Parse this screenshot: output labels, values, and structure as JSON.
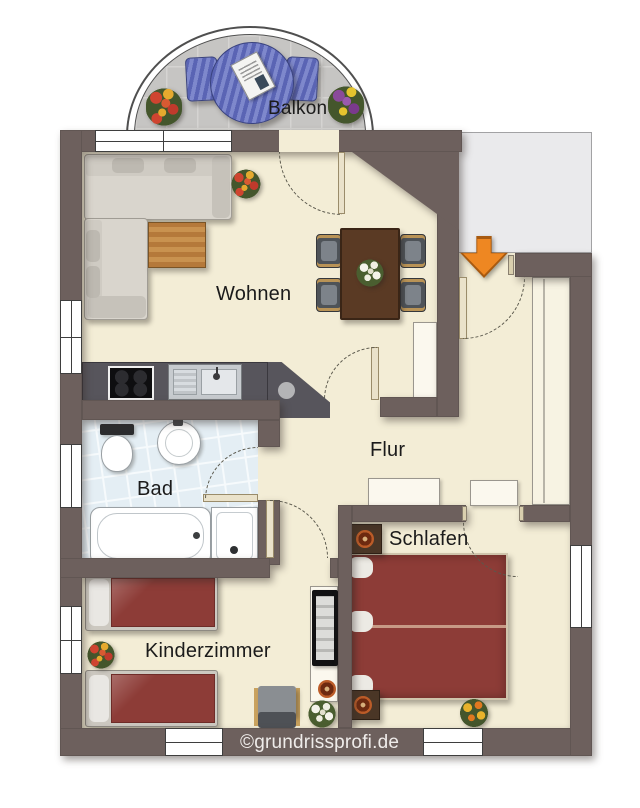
{
  "plan": {
    "watermark": "©grundrissprofi.de",
    "entrance_arrow": {
      "direction": "down",
      "color": "#ee8722"
    },
    "rooms": [
      {
        "id": "balkon",
        "label": "Balkon",
        "furniture": [
          "round-table",
          "chair",
          "chair",
          "newspaper",
          "flower-pot",
          "flower-pot"
        ]
      },
      {
        "id": "wohnen",
        "label": "Wohnen",
        "furniture": [
          "corner-sofa",
          "coffee-table",
          "plant",
          "dining-table",
          "dining-chairs-4",
          "flower-centerpiece"
        ]
      },
      {
        "id": "flur",
        "label": "Flur",
        "furniture": [
          "wardrobe",
          "cabinet",
          "cabinet",
          "closet"
        ]
      },
      {
        "id": "bad",
        "label": "Bad",
        "furniture": [
          "toilet",
          "washbasin",
          "bathtub",
          "shower"
        ]
      },
      {
        "id": "schlafen",
        "label": "Schlafen",
        "furniture": [
          "double-bed",
          "nightstand",
          "nightstand",
          "lamp",
          "lamp",
          "plant"
        ]
      },
      {
        "id": "kinderzimmer",
        "label": "Kinderzimmer",
        "furniture": [
          "single-bed",
          "single-bed",
          "chair",
          "tv-cabinet",
          "tv",
          "lamp",
          "plant",
          "plant"
        ]
      }
    ],
    "kitchen": {
      "appliances": [
        "cooktop",
        "sink"
      ]
    },
    "colors": {
      "wall": "#6d605d",
      "floor": "#f3edd6",
      "bath_floor": "#e3edf4",
      "balcony_floor": "#c6c5c3",
      "exterior_area": "#eaeaec",
      "bed": "#8d3c37",
      "counter": "#57555c",
      "balcony_furniture": "#6a75c0",
      "arrow": "#ee8722",
      "wood_table": "#5a3a24",
      "coffee_table": "#c08c4a"
    }
  }
}
